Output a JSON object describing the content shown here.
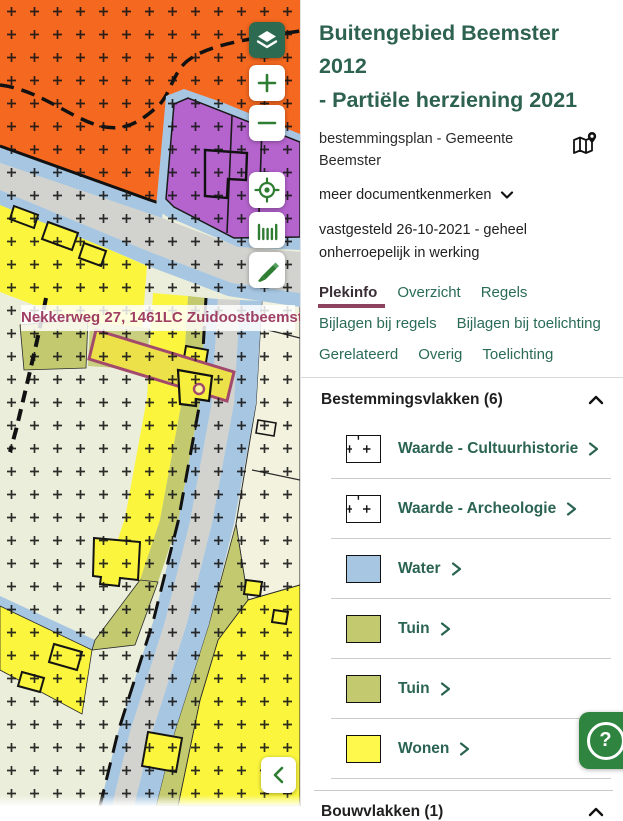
{
  "map": {
    "address_label": "Nekkerweg 27, 1461LC Zuidoostbeemster",
    "controls": {
      "layers": "layers",
      "zoom_in": "+",
      "zoom_out": "−",
      "locate": "locate",
      "measure": "measure",
      "draw": "draw",
      "collapse": "‹"
    },
    "zone_colors": {
      "agrarisch_orange": "#f5681f",
      "bedrijf_purple": "#b564ce",
      "water_blue": "#a7c6e2",
      "verkeer_gray": "#d2d2cf",
      "achtergrond_groen": "#ebeeda",
      "wonen_geel": "#fbf63d",
      "tuin_olijf": "#c2c96e",
      "selectie_paars": "#a3496b"
    }
  },
  "header": {
    "title_line1": "Buitengebied Beemster 2012",
    "title_line2": "- Partiële herziening 2021",
    "subtitle": "bestemmingsplan - Gemeente Beemster",
    "more_link": "meer documentkenmerken",
    "status": "vastgesteld 26-10-2021 - geheel onherroepelijk in werking"
  },
  "tabs": {
    "active": "Plekinfo",
    "items": [
      "Plekinfo",
      "Overzicht",
      "Regels",
      "Bijlagen bij regels",
      "Bijlagen bij toelichting",
      "Gerelateerd",
      "Overig",
      "Toelichting"
    ]
  },
  "sections": {
    "bestemmingsvlakken": {
      "title": "Bestemmingsvlakken (6)",
      "items": [
        {
          "label": "Waarde - Cultuurhistorie",
          "swatch": "cross"
        },
        {
          "label": "Waarde - Archeologie",
          "swatch": "cross"
        },
        {
          "label": "Water",
          "swatch": "#a7c6e2"
        },
        {
          "label": "Tuin",
          "swatch": "#c2c96e"
        },
        {
          "label": "Tuin",
          "swatch": "#c2c96e"
        },
        {
          "label": "Wonen",
          "swatch": "#fdf84b"
        }
      ]
    },
    "bouwvlakken": {
      "title": "Bouwvlakken (1)"
    }
  },
  "help": {
    "label": "?"
  },
  "accent_colors": {
    "title_green": "#2d6150",
    "link_green": "#2a6b57",
    "tab_underline": "#8d4360",
    "label_maroon": "#9f3f63",
    "help_green": "#2f8540"
  }
}
